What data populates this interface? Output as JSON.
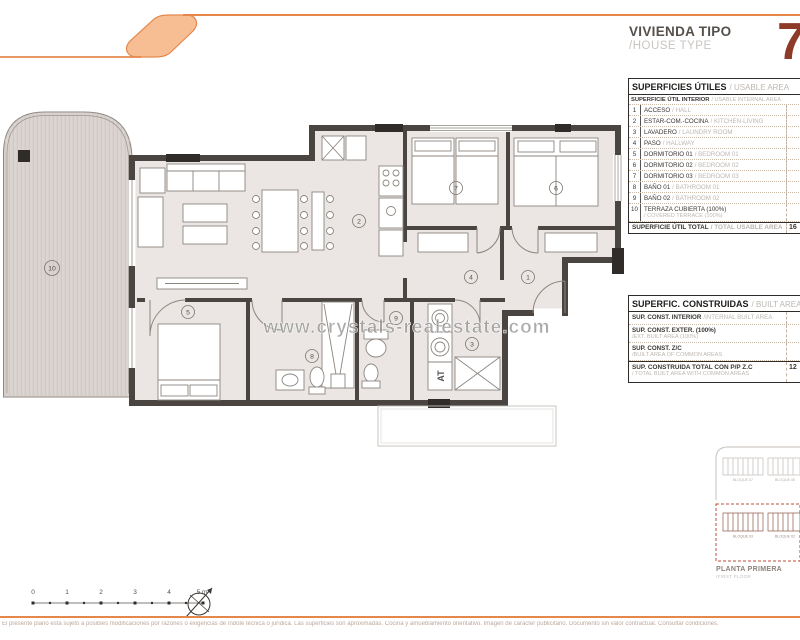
{
  "header": {
    "title": "VIVIENDA TIPO",
    "subtitle": "/HOUSE TYPE",
    "unit_number": "7",
    "accent_color": "#e5874b",
    "number_color": "#8e3a28"
  },
  "usable_table": {
    "title": "SUPERFICIES ÚTILES",
    "title_en": "/ USABLE AREA",
    "subheader": "SUPERFICIE ÚTIL INTERIOR",
    "subheader_en": "/ USABLE INTERNAL AREA",
    "rows": [
      {
        "num": "1",
        "name": "ACCESO",
        "name_en": "/ HALL"
      },
      {
        "num": "2",
        "name": "ESTAR-COM.-COCINA",
        "name_en": "/ KITCHEN-LIVING"
      },
      {
        "num": "3",
        "name": "LAVADERO",
        "name_en": "/ LAUNDRY ROOM"
      },
      {
        "num": "4",
        "name": "PASO",
        "name_en": "/ HALLWAY"
      },
      {
        "num": "5",
        "name": "DORMITORIO 01",
        "name_en": "/ BEDROOM 01"
      },
      {
        "num": "6",
        "name": "DORMITORIO 02",
        "name_en": "/ BEDROOM 02"
      },
      {
        "num": "7",
        "name": "DORMITORIO 03",
        "name_en": "/ BEDROOM 03"
      },
      {
        "num": "8",
        "name": "BAÑO 01",
        "name_en": "/ BATHROOM 01"
      },
      {
        "num": "9",
        "name": "BAÑO 02",
        "name_en": "/ BATHROOM 02"
      },
      {
        "num": "10",
        "name": "TERRAZA CUBIERTA (100%)",
        "name_en": "/ COVERED TERRACE (100%)"
      }
    ],
    "total_label": "SUPERFICIE ÚTIL TOTAL",
    "total_label_en": "/ TOTAL USABLE AREA",
    "total_value": "16"
  },
  "built_table": {
    "title": "SUPERFIC. CONSTRUIDAS",
    "title_en": "/ BUILT AREA",
    "rows": [
      {
        "name": "SUP. CONST. INTERIOR",
        "name_en": "/INTERNAL BUILT AREA"
      },
      {
        "name": "SUP. CONST. EXTER. (100%)",
        "name_en": "/EXT. BUILT AREA (100%)"
      },
      {
        "name": "SUP. CONST. Z/C",
        "name_en": "/BUILT AREA OF COMMON AREAS"
      }
    ],
    "total_label": "SUP. CONSTRUIDA TOTAL CON P/P Z.C",
    "total_label_en": "/ TOTAL BUILT AREA WITH COMMON AREAS",
    "total_value": "12"
  },
  "plan": {
    "watermark": "www.crystals-realestate.com",
    "at_label": "AT",
    "rooms": {
      "r1": "1",
      "r2": "2",
      "r3": "3",
      "r4": "4",
      "r5": "5",
      "r6": "6",
      "r7": "7",
      "r8": "8",
      "r9": "9",
      "r10": "10"
    },
    "wall_color": "#4a4541",
    "floor_color": "#ebe6e3",
    "terrace_color": "#dbd4d0"
  },
  "keyplan": {
    "block_top_left": "BLOQUE 07",
    "block_top_right": "BLOQUE 06",
    "block_bottom_left": "BLOQUE 03",
    "block_bottom_right": "BLOQUE 02",
    "caption": "PLANTA PRIMERA",
    "caption_en": "/FIRST FLOOR",
    "highlight_color": "#bf4a38"
  },
  "scalebar": {
    "labels": [
      "0",
      "1",
      "2",
      "3",
      "4",
      "5 m"
    ]
  },
  "footer": {
    "disclaimer": "El presente plano está sujeto a posibles modificaciones por razones o exigencias de índole técnica o jurídica. Las superficies son aproximadas. Cocina y amueblamiento orientativo. Imagen de carácter publicitario. Documento sin valor contractual. Consultar condiciones."
  }
}
